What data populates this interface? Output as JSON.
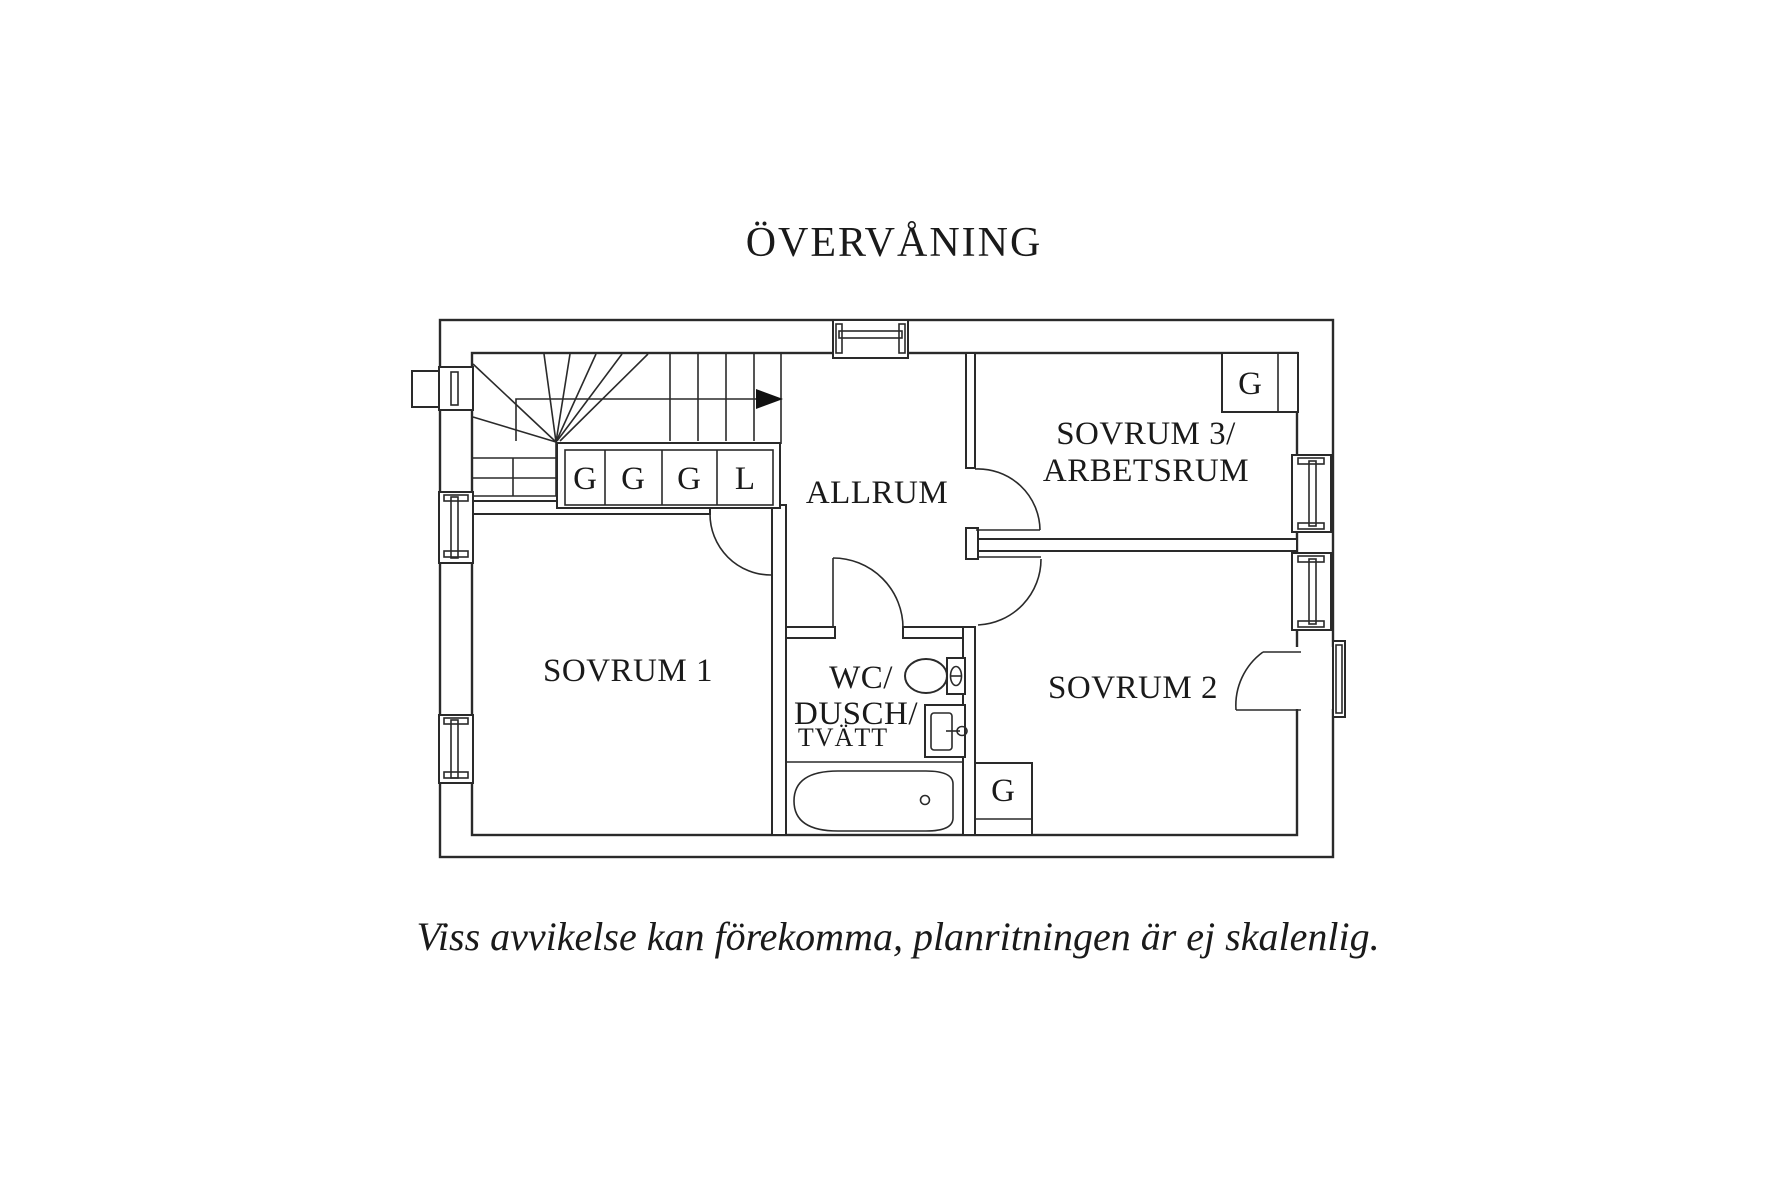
{
  "page": {
    "background": "#ffffff",
    "line_color": "#2a2a2a",
    "text_color": "#1a1a1a"
  },
  "title": "ÖVERVÅNING",
  "floor_plan": {
    "rooms": {
      "allrum": {
        "label": "ALLRUM"
      },
      "sovrum1": {
        "label": "SOVRUM 1"
      },
      "sovrum2": {
        "label": "SOVRUM 2"
      },
      "sovrum3": {
        "label_line1": "SOVRUM 3/",
        "label_line2": "ARBETSRUM"
      },
      "bathroom": {
        "label_line1": "WC/",
        "label_line2": "DUSCH/",
        "label_line3": "TVÄTT"
      }
    },
    "closets": {
      "hall_row": [
        "G",
        "G",
        "G",
        "L"
      ],
      "sovrum3_closet": "G",
      "sovrum2_closet": "G"
    },
    "stair_direction": "up"
  },
  "disclaimer": "Viss avvikelse kan förekomma, planritningen är ej skalenlig."
}
